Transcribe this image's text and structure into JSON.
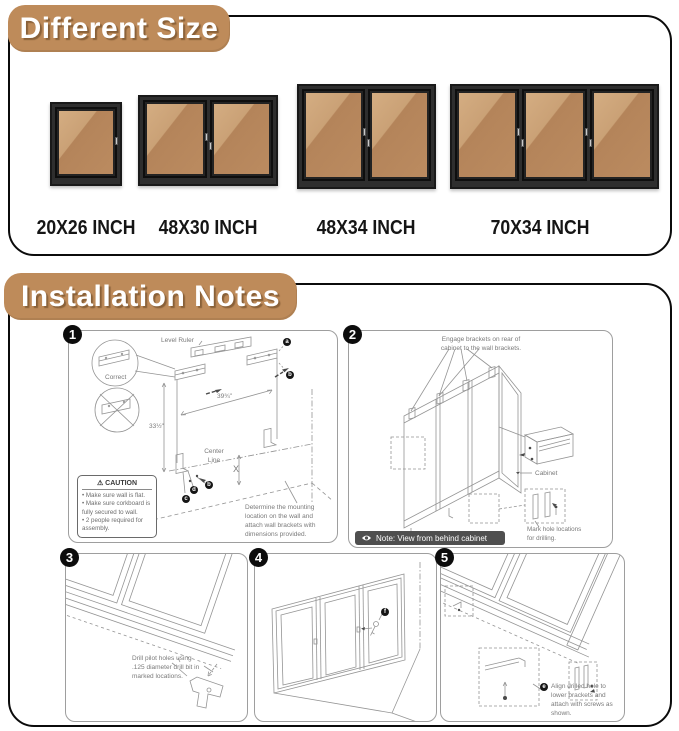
{
  "different_size": {
    "title": "Different Size",
    "boards": [
      {
        "label": "20X26 INCH",
        "doors": 1
      },
      {
        "label": "48X30 INCH",
        "doors": 2
      },
      {
        "label": "48X34 INCH",
        "doors": 2
      },
      {
        "label": "70X34 INCH",
        "doors": 3
      }
    ]
  },
  "installation": {
    "title": "Installation Notes",
    "steps": {
      "s1": {
        "num": "1",
        "level_ruler": "Level Ruler",
        "correct": "Correct",
        "width_dim": "39¾\"",
        "height_dim": "33½\"",
        "center_line": "Center Line",
        "x_dim": "X",
        "caution": {
          "icon": "⚠",
          "title": "CAUTION",
          "items": [
            "Make sure wall is flat.",
            "Make sure corkboard is fully secured to wall.",
            "2 people required for assembly."
          ]
        },
        "note": "Determine the mounting location on the wall and attach wall brackets with dimensions provided.",
        "badges": [
          "a",
          "b",
          "c",
          "d",
          "b"
        ]
      },
      "s2": {
        "num": "2",
        "engage_note": "Engage brackets on rear of cabinet to the wall brackets.",
        "cabinet_label": "Cabinet",
        "mark_note": "Mark hole locations for drilling.",
        "view_note": "Note: View from behind cabinet"
      },
      "s3": {
        "num": "3",
        "drill_note": "Drill pilot holes using .125 diameter drill bit in marked locations."
      },
      "s4": {
        "num": "4",
        "badge": "f"
      },
      "s5": {
        "num": "5",
        "badge": "e",
        "align_note": "Align drilled hole to lower brackets and attach with screws as shown."
      }
    }
  },
  "colors": {
    "accent_tan": "#BE8B5A",
    "cork": "#BB8B60",
    "cork_glare": "#D4AD82",
    "frame_black": "#2E2E2E",
    "line_gray": "#949494",
    "note_bar_bg": "#4F4F4F"
  }
}
